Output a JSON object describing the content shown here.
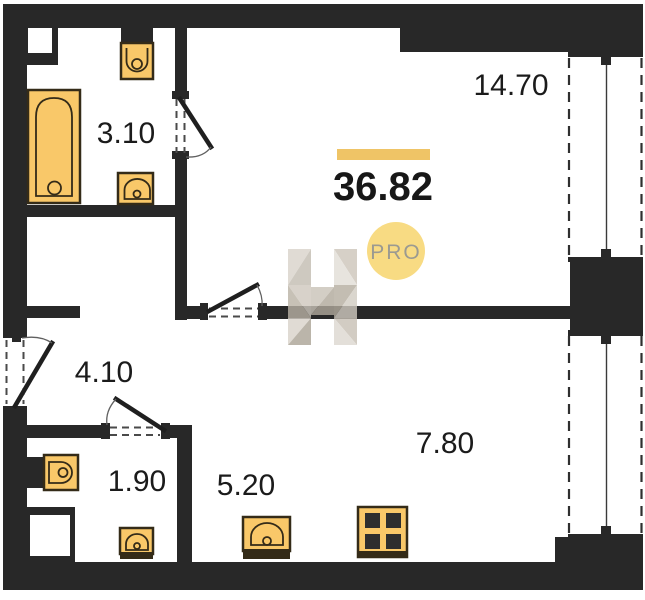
{
  "total": {
    "area": "36.82"
  },
  "badge": {
    "label": "PRO"
  },
  "watermark": {
    "letter": "H"
  },
  "rooms": [
    {
      "name": "bathroom",
      "area": "3.10"
    },
    {
      "name": "living-room",
      "area": "14.70"
    },
    {
      "name": "hallway",
      "area": "4.10"
    },
    {
      "name": "wc",
      "area": "1.90"
    },
    {
      "name": "kitchen-niche",
      "area": "5.20"
    },
    {
      "name": "kitchen",
      "area": "7.80"
    }
  ],
  "colors": {
    "wall": "#282828",
    "fixture": "#F9C869",
    "fixture_border": "#342B18",
    "accent_bar": "#EFC466",
    "badge_fill": "#F8DB83",
    "badge_text": "#9B9A91"
  }
}
